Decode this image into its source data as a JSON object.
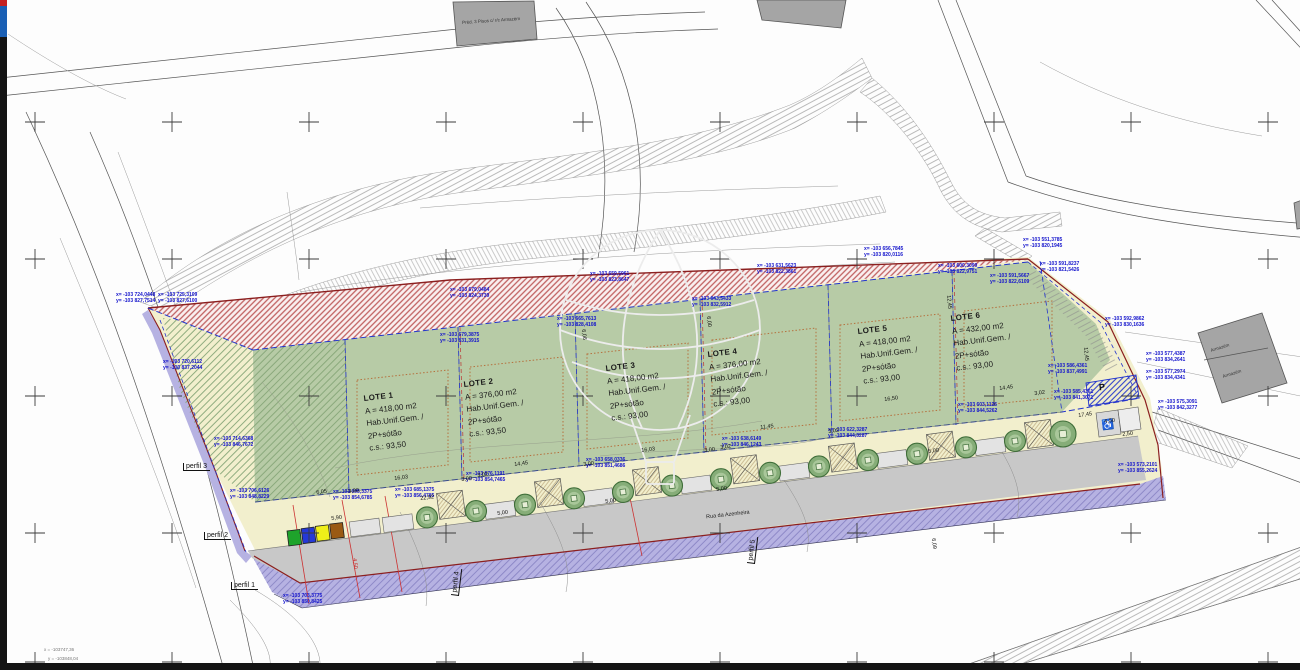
{
  "road_label": "Rua da Azenheira",
  "symbols": {
    "parking": "P",
    "accessibility": "♿"
  },
  "colors": {
    "lot_green": "#b7cba6",
    "sidewalk_cream": "#f2efcd",
    "road_gray": "#c8c8c8",
    "easement_purple": "#b6b2e2",
    "boundary_red": "#8b1f1f",
    "annotation_blue": "#1414cc",
    "setback_orange": "#b5703d",
    "legend_swatches": [
      "#1ea32b",
      "#2438d8",
      "#efef19",
      "#9a5a13"
    ]
  },
  "lots": [
    {
      "x": 363,
      "y": 393,
      "name": "LOTE 1",
      "area": "A = 418,00 m2",
      "use": "Hab.Unif.Gem. /",
      "floors": "2P+sótão",
      "cs": "c.s.: 93,50"
    },
    {
      "x": 463,
      "y": 379,
      "name": "LOTE 2",
      "area": "A = 376,00 m2",
      "use": "Hab.Unif.Gem. /",
      "floors": "2P+sótão",
      "cs": "c.s.: 93,50"
    },
    {
      "x": 605,
      "y": 363,
      "name": "LOTE 3",
      "area": "A = 418,00 m2",
      "use": "Hab.Unif.Gem. /",
      "floors": "2P+sótão",
      "cs": "c.s.: 93,00"
    },
    {
      "x": 707,
      "y": 349,
      "name": "LOTE 4",
      "area": "A = 376,00 m2",
      "use": "Hab.Unif.Gem. /",
      "floors": "2P+sótão",
      "cs": "c.s.: 93,00"
    },
    {
      "x": 857,
      "y": 326,
      "name": "LOTE 5",
      "area": "A = 418,00 m2",
      "use": "Hab.Unif.Gem. /",
      "floors": "2P+sótão",
      "cs": "c.s.: 93,00"
    },
    {
      "x": 950,
      "y": 313,
      "name": "LOTE 6",
      "area": "A = 432,00 m2",
      "use": "Hab.Unif.Gem. /",
      "floors": "2P+sótão",
      "cs": "c.s.: 93,00"
    }
  ],
  "coord_labels": [
    [
      116,
      293,
      "x= -103 724,0448",
      "y= -103 827,7514"
    ],
    [
      158,
      293,
      "x= -103 725,3109",
      "y= -103 827,6100"
    ],
    [
      163,
      360,
      "x= -103 720,6112",
      "y= -103 837,2044"
    ],
    [
      214,
      437,
      "x= -103 714,6368",
      "y= -103 846,7672"
    ],
    [
      230,
      489,
      "x= -103 706,6126",
      "y= -103 848,8229"
    ],
    [
      333,
      490,
      "x= -103 695,3375",
      "y= -103 854,6785"
    ],
    [
      283,
      594,
      "x= -103 703,3775",
      "y= -103 850,8425"
    ],
    [
      450,
      288,
      "x= -103 679,0484",
      "y= -103 824,3739"
    ],
    [
      440,
      333,
      "x= -103 679,3875",
      "y= -103 831,3915"
    ],
    [
      557,
      317,
      "x= -103 665,7613",
      "y= -103 828,4108"
    ],
    [
      466,
      472,
      "x= -103 676,1191",
      "y= -103 854,7465"
    ],
    [
      395,
      488,
      "x= -103 685,1375",
      "y= -103 856,4785"
    ],
    [
      586,
      458,
      "x= -103 658,0336",
      "y= -103 851,4686"
    ],
    [
      692,
      297,
      "x= -103 643,5433",
      "y= -103 832,5912"
    ],
    [
      590,
      272,
      "x= -103 659,5961",
      "y= -103 823,8647"
    ],
    [
      864,
      247,
      "x= -103 656,7845",
      "y= -103 820,0116"
    ],
    [
      757,
      264,
      "x= -103 631,5623",
      "y= -103 822,3861"
    ],
    [
      722,
      437,
      "x= -103 638,6149",
      "y= -103 846,1243"
    ],
    [
      828,
      428,
      "x= -103 622,3287",
      "y= -103 844,3287"
    ],
    [
      958,
      403,
      "x= -103 603,1126",
      "y= -103 844,5262"
    ],
    [
      1023,
      238,
      "x= -103 551,3785",
      "y= -103 820,1945"
    ],
    [
      1040,
      262,
      "x= -103 591,8237",
      "y= -103 821,5426"
    ],
    [
      938,
      264,
      "x= -103 600,3099",
      "y= -103 822,9751"
    ],
    [
      990,
      274,
      "x= -103 591,5667",
      "y= -103 822,6109"
    ],
    [
      1105,
      317,
      "x= -103 592,9862",
      "y= -103 830,1636"
    ],
    [
      1048,
      364,
      "x= -103 586,4361",
      "y= -103 837,4991"
    ],
    [
      1054,
      390,
      "x= -103 585,4361",
      "y= -103 841,3071"
    ],
    [
      1146,
      352,
      "x= -103 577,4387",
      "y= -103 834,2641"
    ],
    [
      1146,
      370,
      "x= -103 577,2974",
      "y= -103 834,4341"
    ],
    [
      1158,
      400,
      "x= -103 575,3091",
      "y= -103 842,3277"
    ],
    [
      1118,
      463,
      "x= -103 573,2101",
      "y= -103 855,2624"
    ]
  ],
  "dim_labels": [
    [
      316,
      490,
      -7,
      "6,05"
    ],
    [
      394,
      476,
      -7,
      "16,03"
    ],
    [
      348,
      489,
      -7,
      "3,00"
    ],
    [
      514,
      462,
      -7,
      "14,45"
    ],
    [
      461,
      477,
      -7,
      "3,00"
    ],
    [
      477,
      473,
      -7,
      "3,02"
    ],
    [
      641,
      448,
      -7,
      "16,03"
    ],
    [
      583,
      462,
      -7,
      "3,00"
    ],
    [
      760,
      425,
      -7,
      "11,45"
    ],
    [
      704,
      448,
      -7,
      "3,00"
    ],
    [
      720,
      445,
      -7,
      "3,02"
    ],
    [
      884,
      397,
      -7,
      "16,50"
    ],
    [
      828,
      429,
      -7,
      "3,02"
    ],
    [
      999,
      386,
      -7,
      "14,45"
    ],
    [
      1034,
      391,
      -7,
      "3,02"
    ],
    [
      1078,
      413,
      -7,
      "17,45"
    ],
    [
      497,
      511,
      -7,
      "5,00"
    ],
    [
      605,
      499,
      -7,
      "5,00"
    ],
    [
      716,
      487,
      -7,
      "5,00"
    ],
    [
      928,
      449,
      -7,
      "5,00"
    ],
    [
      331,
      516,
      -7,
      "5,90"
    ],
    [
      420,
      496,
      -7,
      "22,92"
    ],
    [
      586,
      329,
      84,
      "6,06"
    ],
    [
      711,
      316,
      84,
      "6,00"
    ],
    [
      951,
      295,
      84,
      "12,45"
    ],
    [
      1088,
      347,
      84,
      "12,45"
    ],
    [
      936,
      538,
      84,
      "6,09"
    ],
    [
      1122,
      432,
      -7,
      "2,50"
    ],
    [
      1104,
      419,
      -7,
      "4,50"
    ],
    [
      357,
      558,
      84,
      "4,50",
      "red"
    ]
  ],
  "perfil_labels": [
    [
      183,
      463,
      0,
      "perfil 3"
    ],
    [
      204,
      532,
      0,
      "perfil 2"
    ],
    [
      231,
      582,
      0,
      "perfil 1"
    ],
    [
      451,
      595,
      -83,
      "perfil 4"
    ],
    [
      747,
      563,
      -83,
      "perfil 5"
    ]
  ],
  "corner_texts": [
    [
      44,
      647,
      "x = -103747,36"
    ],
    [
      48,
      656,
      "y = -103848,04"
    ]
  ],
  "building_labels": [
    [
      462,
      20,
      -4,
      "Préd. 3 Pisos c/ r/c Armazém"
    ],
    [
      1210,
      348,
      -17,
      "Armazém"
    ],
    [
      1222,
      374,
      -17,
      "Armazém"
    ]
  ]
}
